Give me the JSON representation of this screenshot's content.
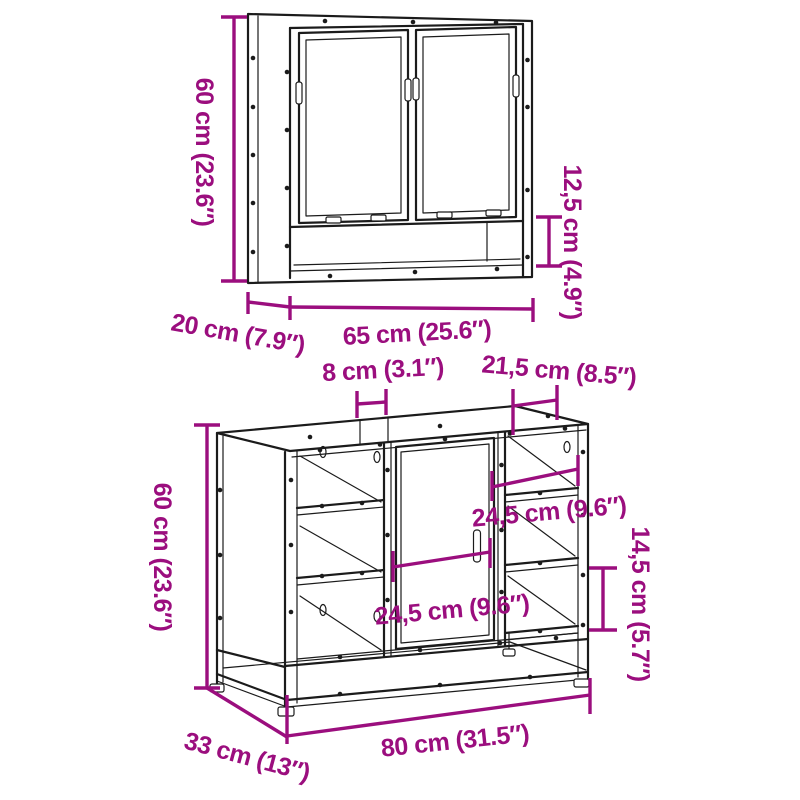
{
  "colors": {
    "background": "#ffffff",
    "line": "#1b1b1b",
    "dimension": "#9b0e7e"
  },
  "mirror_cabinet": {
    "dims": {
      "height": "60 cm (23.6″)",
      "depth": "20 cm (7.9″)",
      "width": "65 cm (25.6″)",
      "open_shelf_height": "12,5 cm (4.9″)"
    }
  },
  "sink_cabinet": {
    "dims": {
      "height": "60 cm (23.6″)",
      "depth": "33 cm (13″)",
      "width": "80 cm (31.5″)",
      "top_gap_width": "8 cm (3.1″)",
      "top_right_panel_width": "21,5 cm (8.5″)",
      "right_compartment_width": "24,5 cm (9.6″)",
      "door_width": "24,5 cm (9.6″)",
      "right_shelf_spacing": "14,5 cm (5.7″)"
    }
  }
}
